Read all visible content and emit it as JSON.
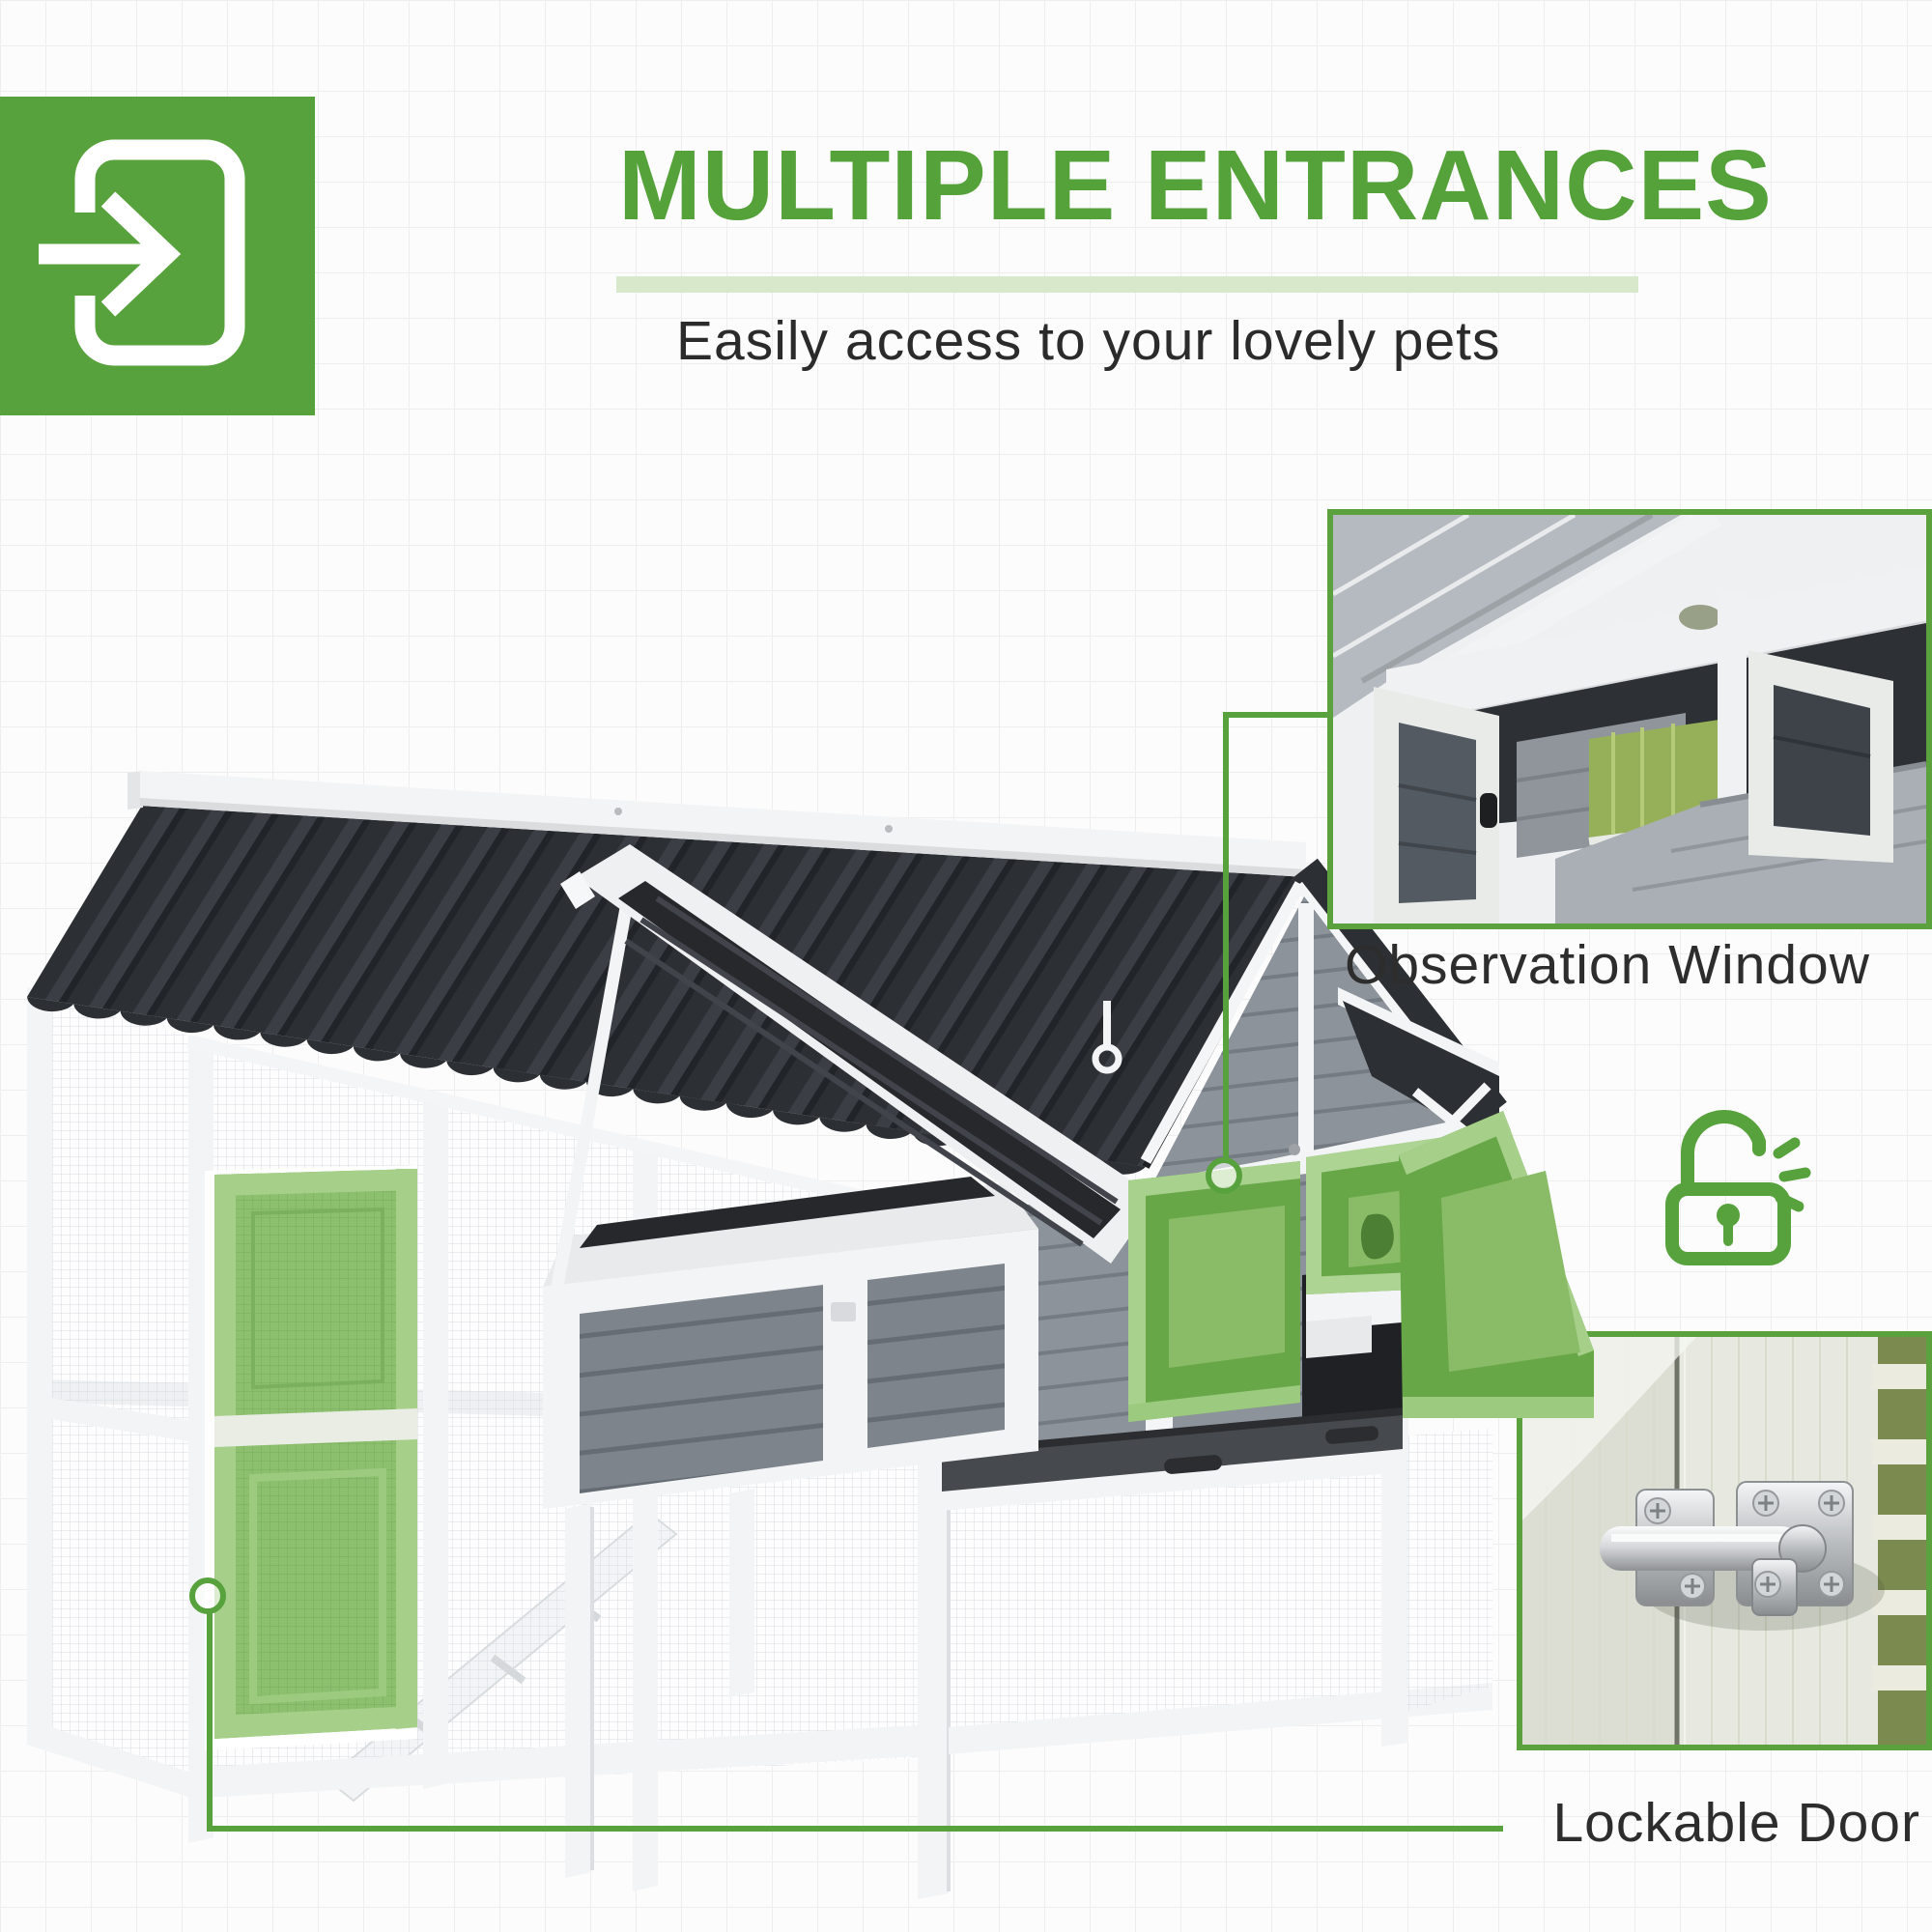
{
  "header": {
    "title": "MULTIPLE ENTRANCES",
    "subtitle": "Easily access to your lovely pets"
  },
  "callouts": [
    {
      "label": "Observation Window"
    },
    {
      "label": "Lockable Door"
    }
  ],
  "icons": {
    "badge": "enter-door-arrow-icon",
    "security": "unlocked-padlock-icon",
    "markers": "circle-connector-marker"
  },
  "colors": {
    "accent": "#58a23e",
    "accent-border": "#5ba23f",
    "title-green": "#55a13a",
    "pale-bar": "#d8e8cb",
    "text-dark": "#2d2d2d",
    "roof-dark": "#2c2f33",
    "siding-gray": "#8d939b",
    "trim-white": "#f2f4f5",
    "door-mesh-green": "#8cc06f",
    "overlay-door-green": "#68a748",
    "grid-line": "#efeeee",
    "bg": "#fcfcfc"
  }
}
